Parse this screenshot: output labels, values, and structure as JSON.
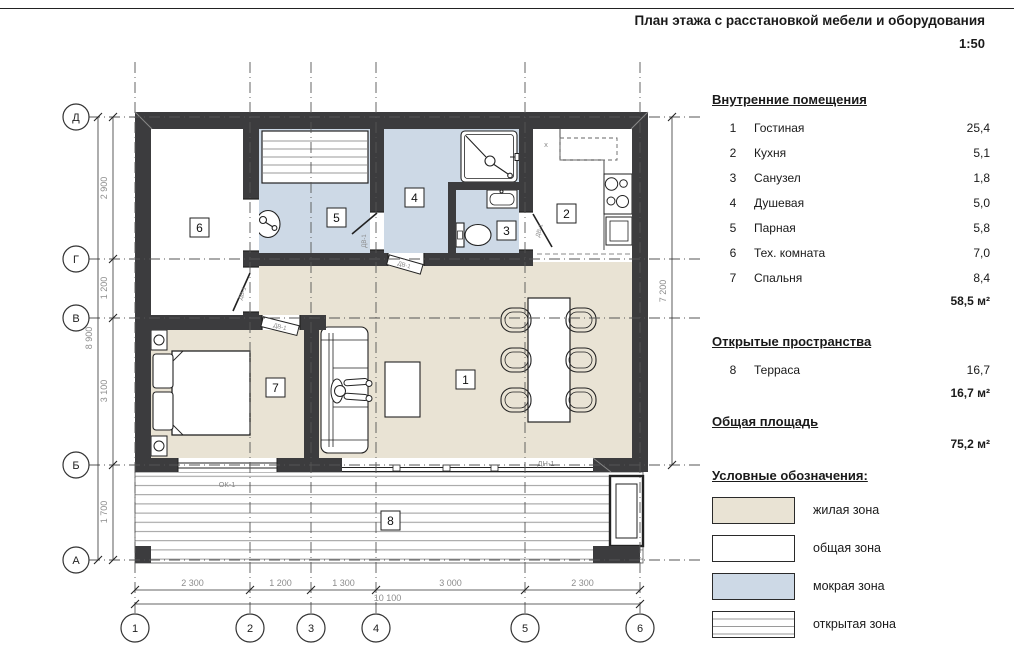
{
  "header": {
    "title": "План этажа с расстановкой мебели и оборудования",
    "scale": "1:50"
  },
  "panel": {
    "interior": {
      "heading": "Внутренние помещения",
      "rows": [
        {
          "n": "1",
          "name": "Гостиная",
          "area": "25,4"
        },
        {
          "n": "2",
          "name": "Кухня",
          "area": "5,1"
        },
        {
          "n": "3",
          "name": "Санузел",
          "area": "1,8"
        },
        {
          "n": "4",
          "name": "Душевая",
          "area": "5,0"
        },
        {
          "n": "5",
          "name": "Парная",
          "area": "5,8"
        },
        {
          "n": "6",
          "name": "Тех. комната",
          "area": "7,0"
        },
        {
          "n": "7",
          "name": "Спальня",
          "area": "8,4"
        }
      ],
      "total": "58,5 м²"
    },
    "open": {
      "heading": "Открытые пространства",
      "rows": [
        {
          "n": "8",
          "name": "Терраса",
          "area": "16,7"
        }
      ],
      "total": "16,7 м²"
    },
    "total_area": {
      "heading": "Общая площадь",
      "total": "75,2 м²"
    },
    "legend": {
      "heading": "Условные обозначения:",
      "items": [
        {
          "label": "жилая зона"
        },
        {
          "label": "общая зона"
        },
        {
          "label": "мокрая зона"
        },
        {
          "label": "открытая зона"
        }
      ]
    }
  },
  "plan": {
    "axis_rows": [
      "Д",
      "Г",
      "В",
      "Б",
      "А"
    ],
    "axis_cols": [
      "1",
      "2",
      "3",
      "4",
      "5",
      "6"
    ],
    "dims_left": [
      "2 900",
      "1 200",
      "3 100",
      "1 700"
    ],
    "dims_bottom": [
      "2 300",
      "1 200",
      "1 300",
      "3 000",
      "2 300"
    ],
    "dim_totals": {
      "left": "8 900",
      "bottom": "10 100",
      "right": "7 200"
    },
    "rooms": [
      "1",
      "2",
      "3",
      "4",
      "5",
      "6",
      "7",
      "8"
    ],
    "labels": {
      "door": "ДВ-1",
      "window": "ОК-1",
      "ext_door": "ДН-1",
      "hood": "x"
    }
  },
  "colors": {
    "wall": "#3c3c3e",
    "living_zone": "#e9e3d4",
    "wet_zone": "#cdd9e6",
    "common_zone": "#ffffff",
    "open_zone_stripe": "#9a9a9a",
    "dim_text": "#8c8c8c"
  }
}
